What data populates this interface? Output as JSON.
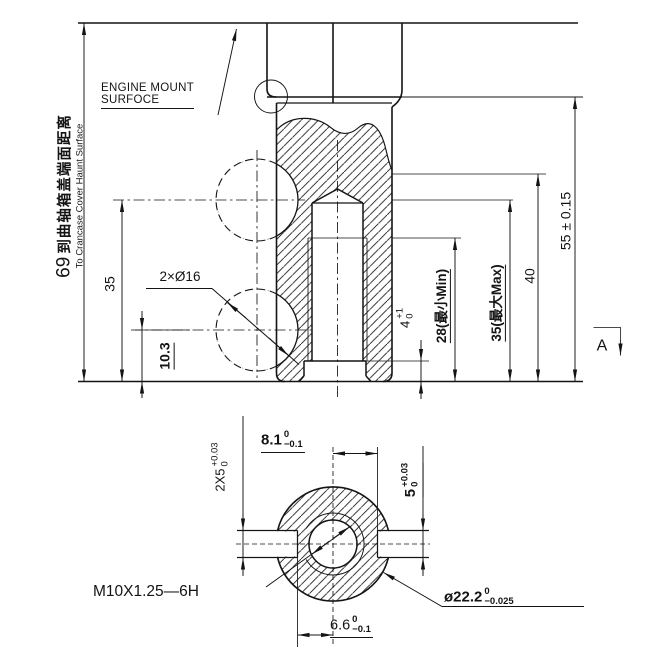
{
  "page": {
    "background": "#ffffff",
    "line_color": "#141414"
  },
  "labels": {
    "engine_mount": {
      "line1": "ENGINE MOUNT",
      "line2": "SURFOCE"
    },
    "section_arrow": "A",
    "thread_callout": "M10X1.25—6H",
    "holes_callout": "2×Ø16"
  },
  "dimensions": {
    "to_crankcase": {
      "value": "69",
      "zh": "到曲轴箱盖端面距离",
      "en": "To Crancase Cover Haunt Surface"
    },
    "hole_center_height": {
      "value": "35"
    },
    "lower_hole_height": {
      "value": "10.3"
    },
    "counterbore_depth": {
      "value": "4",
      "tol_top": "+1",
      "tol_bot": "0"
    },
    "thread_depth_min": {
      "value": "28(最小Min)"
    },
    "drill_depth_max": {
      "value": "35(最大Max)"
    },
    "depth_40": {
      "value": "40"
    },
    "overall_height": {
      "value": "55 ± 0.15"
    },
    "slot_width_double": {
      "value": "2X5",
      "tol_top": "+0.03",
      "tol_bot": "0"
    },
    "slot_offset_right": {
      "value": "8.1",
      "tol_top": "0",
      "tol_bot": "−0.1"
    },
    "slot_width": {
      "value": "5",
      "tol_top": "+0.03",
      "tol_bot": "0"
    },
    "boss_diameter": {
      "value": "ø22.2",
      "tol_top": "0",
      "tol_bot": "−0.025"
    },
    "slot_offset_left": {
      "value": "6.6",
      "tol_top": "0",
      "tol_bot": "−0.1"
    }
  }
}
